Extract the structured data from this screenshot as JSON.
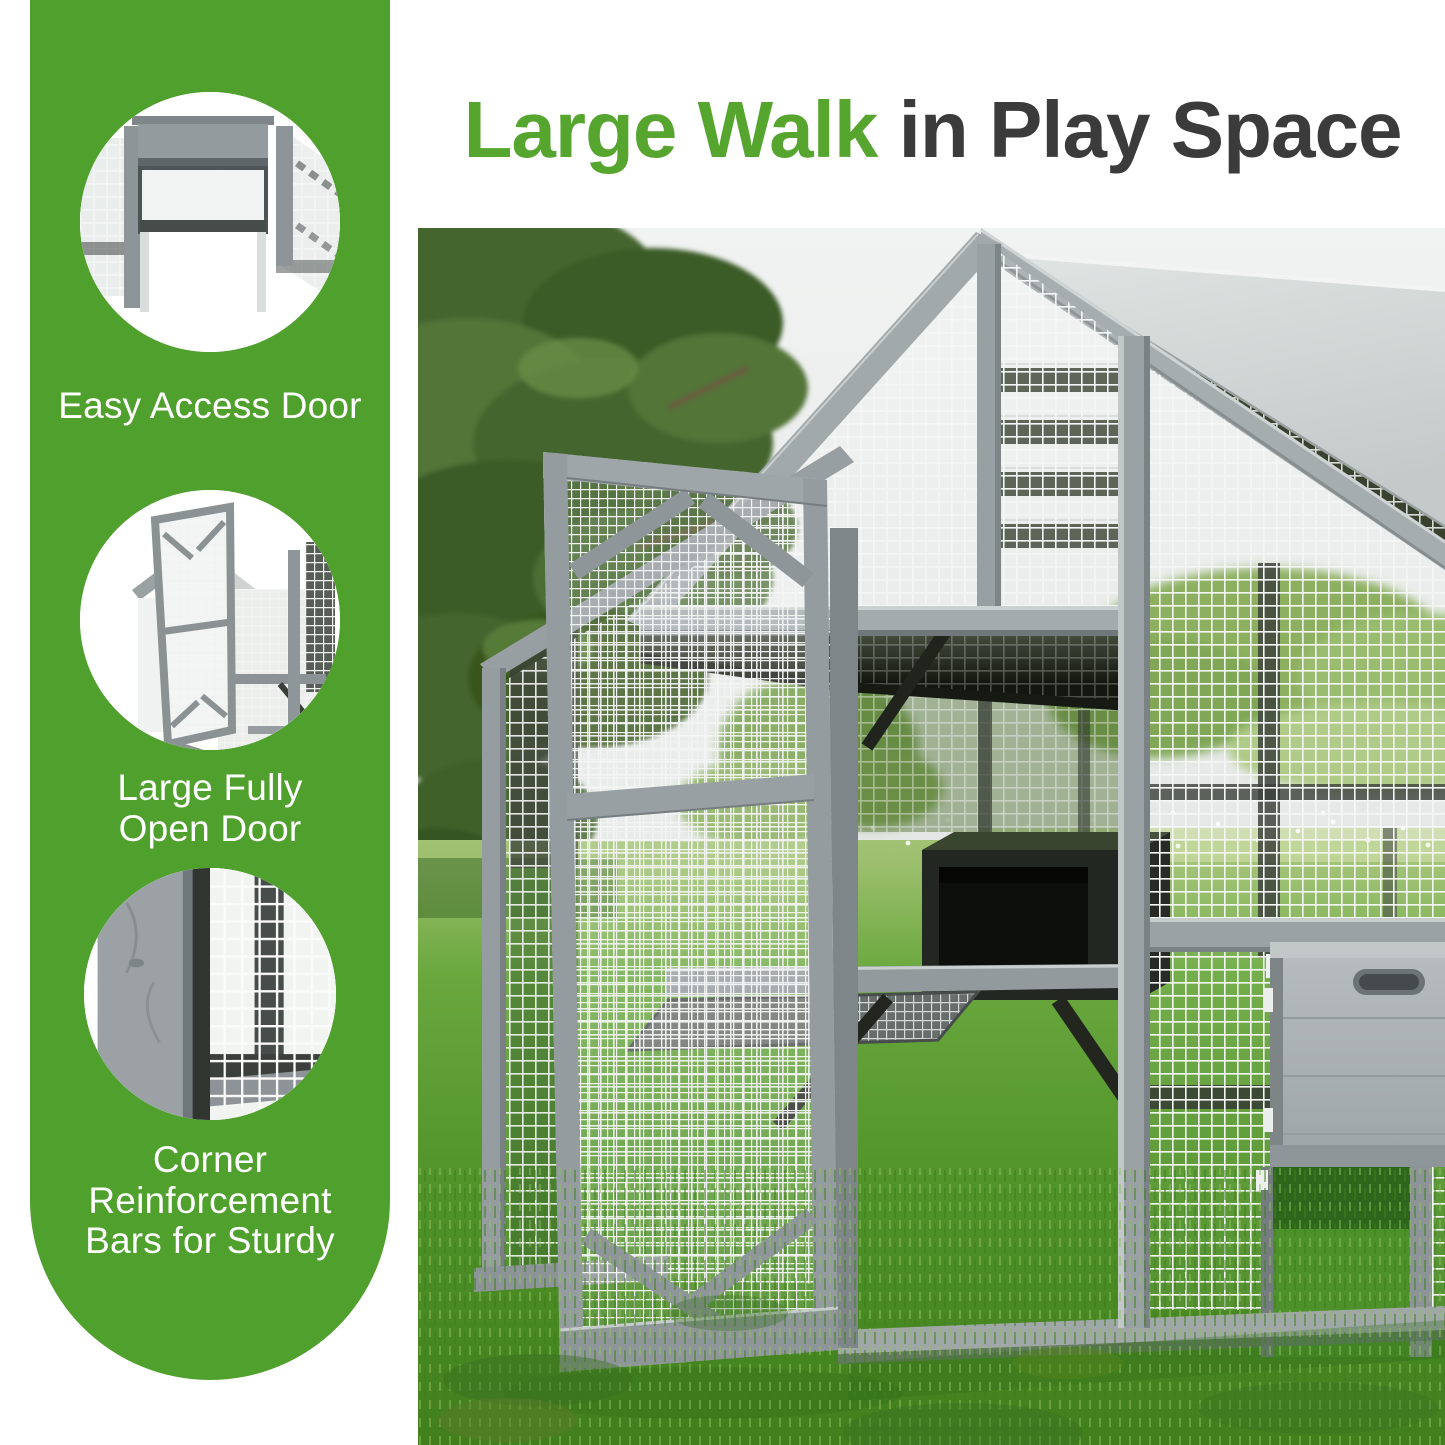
{
  "title": {
    "highlight": "Large Walk",
    "rest": " in Play Space"
  },
  "banner": {
    "features": [
      {
        "name": "easy-access-door",
        "lines": [
          "Easy Access Door"
        ]
      },
      {
        "name": "large-fully-open-door",
        "lines": [
          "Large Fully",
          "Open Door"
        ]
      },
      {
        "name": "corner-reinforcement",
        "lines": [
          "Corner",
          "Reinforcement",
          "Bars for Sturdy"
        ]
      }
    ]
  },
  "palette": {
    "banner_green": "#4fa02c",
    "title_green": "#55a52f",
    "title_dark": "#3b3b3b",
    "label_white": "#ffffff",
    "wood_gray": "#9aa1a4",
    "wood_dark": "#6f7779",
    "mesh_white": "#f4f6f5",
    "roof_gray": "#ccd2d1",
    "interior_dark": "#23281f",
    "grass_green": "#4f9228",
    "grass_light": "#a6c477",
    "sky_gray": "#edf0ee",
    "pine_green": "#44652f",
    "hedge_green": "#84aa52",
    "box_gray": "#aab0b2"
  }
}
